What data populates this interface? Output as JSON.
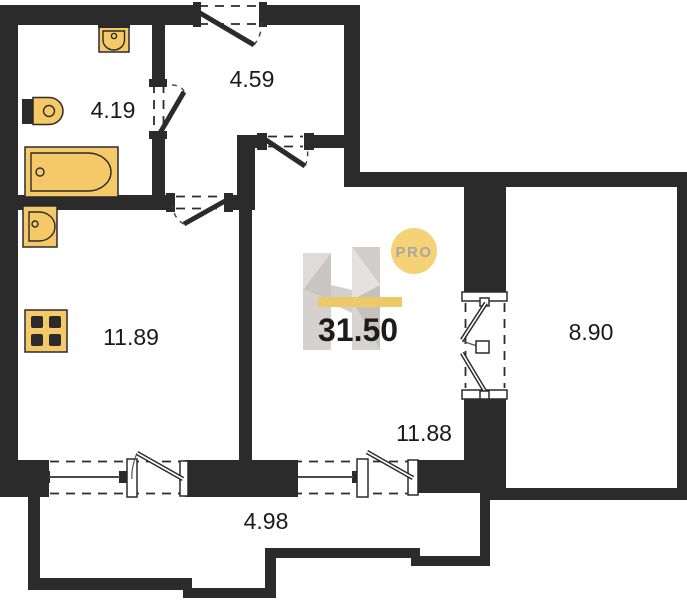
{
  "plan": {
    "watermark": {
      "badge": "PRO",
      "letter": "H"
    },
    "total": {
      "area": "31.50"
    },
    "rooms": {
      "bathroom": {
        "area": "4.19"
      },
      "hallway": {
        "area": "4.59"
      },
      "kitchen": {
        "area": "11.89"
      },
      "living": {
        "area": "11.88"
      },
      "balcony_right": {
        "area": "8.90"
      },
      "balcony_bottom": {
        "area": "4.98"
      }
    },
    "colors": {
      "wall": "#2b2b2b",
      "fixture_fill": "#f6c968",
      "logo_yellow": "#f5d06f",
      "logo_bar": "#efc75e",
      "text": "#1a1a1a"
    },
    "icons": [
      "sink-icon",
      "toilet-icon",
      "bathtub-icon",
      "kitchen-sink-icon",
      "stove-icon",
      "entrance-door-icon",
      "bathroom-door-icon",
      "kitchen-door-icon",
      "living-door-icon",
      "balcony-door-icon",
      "window-icon",
      "logo-watermark"
    ]
  }
}
